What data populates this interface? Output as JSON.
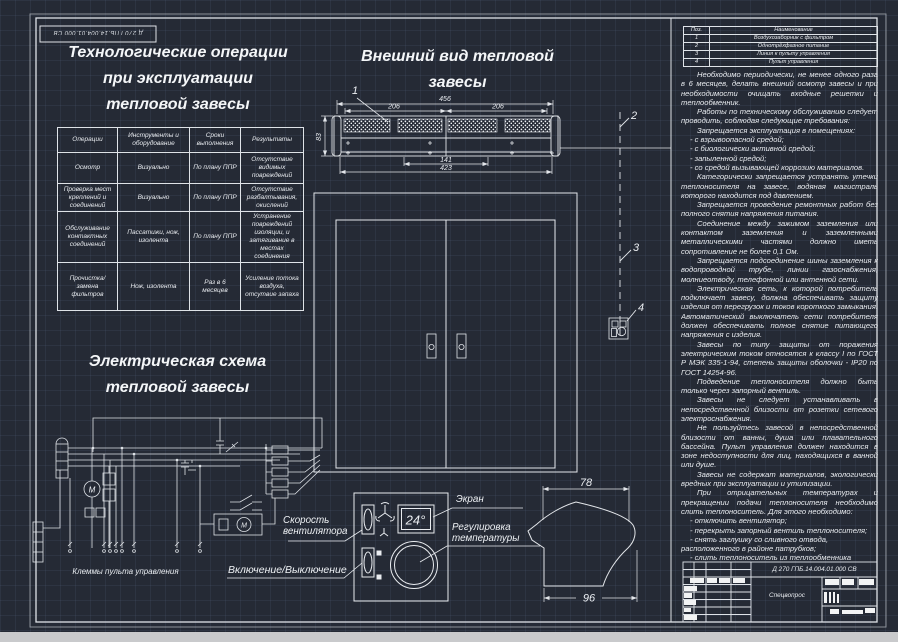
{
  "stamp": {
    "code": "Д 270 ГПБ.14.004.01.000 СВ"
  },
  "operations": {
    "title_lines": [
      "Технологические операции",
      "при эксплуатации",
      "тепловой завесы"
    ],
    "table": {
      "headers": [
        "Операции",
        "Инструменты и оборудование",
        "Сроки выполнения",
        "Результаты"
      ],
      "rows": [
        [
          "Осмотр",
          "Визуально",
          "По плану ППР",
          "Отсутствие видимых повреждений"
        ],
        [
          "Проверка мест креплений и соединений",
          "Визуально",
          "По плану ППР",
          "Отсутствие разбалтывания, окислений"
        ],
        [
          "Обслуживание контактных соединений",
          "Пассатижи, нож, изолента",
          "По плану ППР",
          "Устранение повреждений изоляции, и затягивание в местах соединения"
        ],
        [
          "Прочистка/замена фильтров",
          "Нож, изолента",
          "Раз в 6 месяцев",
          "Усиление потока воздуха, отсутвие запаха"
        ]
      ]
    }
  },
  "appearance": {
    "title_lines": [
      "Внешний вид тепловой",
      "завесы"
    ],
    "dims": {
      "overall_width": "456",
      "segment_left": "206",
      "segment_right": "206",
      "mount_span": "141",
      "bottom_width": "423",
      "height": "83"
    },
    "callouts": {
      "c1": "1",
      "c2": "2",
      "c3": "3",
      "c4": "4"
    }
  },
  "profile": {
    "dims": {
      "top": "78",
      "bottom": "96"
    }
  },
  "schematic": {
    "title_lines": [
      "Электрическая схема",
      "тепловой завесы"
    ],
    "terminals_label": "Клеммы  пульта управления"
  },
  "panel": {
    "display": "24°",
    "label_screen": "Экран",
    "label_fan": [
      "Скорость",
      "вентилятора"
    ],
    "label_temp": [
      "Регулировка",
      "температуры"
    ],
    "label_power": "Включение/Выключение"
  },
  "parts": {
    "headers": [
      "Поз.",
      "Наименование"
    ],
    "rows": [
      [
        "1",
        "Воздухозаборник с фильтром"
      ],
      [
        "2",
        "Однотрёхфазное питание"
      ],
      [
        "3",
        "Линия к пульту управления"
      ],
      [
        "4",
        "Пульт управления"
      ]
    ]
  },
  "instructions": {
    "paragraphs": [
      "Необходимо периодически, не менее одного раза в 6 месяцев, делать внешний осмотр завесы и при необходимости очищать входные решетки и теплообменник.",
      "Работы по техническому обслуживанию следует проводить, соблюдая следующие требования:",
      "Запрещается эксплуатация в помещениях:",
      "- с взрывоопасной средой;",
      "- с биологически активной средой;",
      "- запыленной средой;",
      "- со средой вызывающей коррозию материалов.",
      "Категорически запрещается устранять утечки теплоносителя на завесе, водяная магистраль которого находится под давлением.",
      "Запрещается проведение ремонтных работ без полного снятия напряжения питания.",
      "Соединение между зажимом заземления или контактом заземления и заземленными металлическими частями должно иметь сопротивление не более 0,1 Ом.",
      "Запрещается подсоединение шины заземления к водопроводной трубе, линии газоснабжения, молниеотводу, телефонной или антенной сети.",
      "Электрическая сеть, к которой потребитель подключает завесу, должна обеспечивать защиту изделия от перегрузок и токов короткого замыкания. Автоматический выключатель сети потребителя должен обеспечивать полное снятие питающего напряжения с изделия.",
      "Завесы по типу защиты от поражения электрическим током относятся к классу I по ГОСТ Р МЭК 335-1-94, степень защиты оболочки - IP20 по ГОСТ 14254-96.",
      "Подведение теплоносителя должно быть только через запорный вентиль.",
      "Завесы не следует устанавливать в непосредственной близости от розетки сетевого электроснабжения.",
      "Не пользуйтесь завесой в непосредственной близости от ванны, душа или плавательного бассейна. Пульт управления должен находится в зоне недоступности для лиц, находящихся в ванной или душе.",
      "Завесы не содержат материалов, экологически вредных при эксплуатации и утилизации.",
      "При отрицательных температурах и прекращении подачи теплоносителя необходимо слить теплоноситель. Для этого необходимо:",
      "- отключить вентилятор;",
      "- перекрыть запорный вентиль теплоносителя;",
      "- снять заглушку со сливного отвода, расположенного в районе патрубков;",
      "- слить теплоноситель из теплообменника завесы;",
      "- установить заглушку."
    ]
  },
  "title_block": {
    "doc_number": "Д 270 ГПБ.14.004.01.000 СВ",
    "topic": "Спецвопрос"
  },
  "colors": {
    "background": "#252a35",
    "line": "#e3e6ea",
    "text": "#eceff3",
    "bottom_bar": "#c9cacc"
  }
}
